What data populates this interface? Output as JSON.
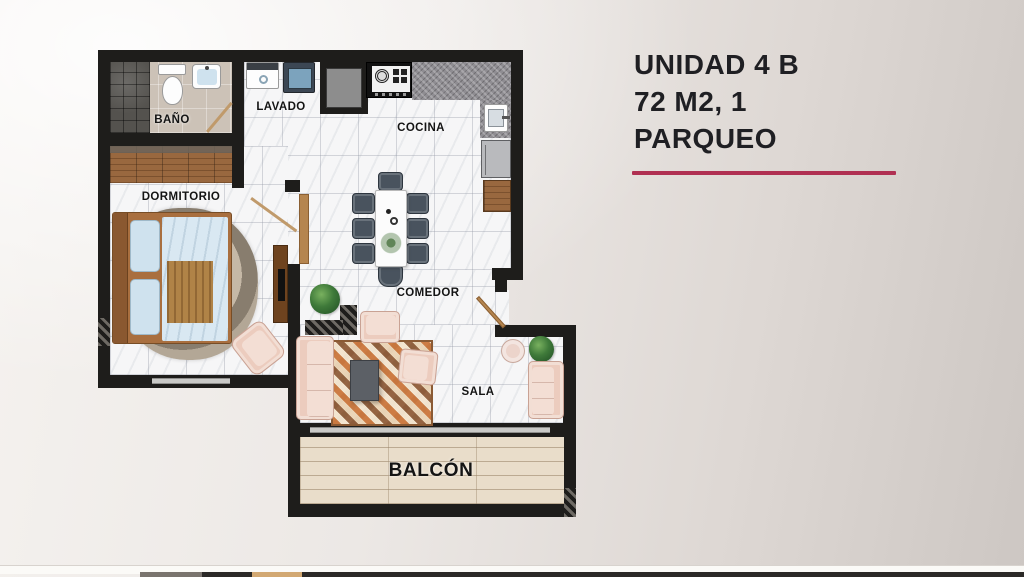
{
  "slide": {
    "title_lines": [
      "UNIDAD 4 B",
      "72 M2, 1",
      "PARQUEO"
    ],
    "accent_color": "#b03052"
  },
  "floorplan": {
    "rooms": {
      "bano": "BAÑO",
      "lavado": "LAVADO",
      "cocina": "COCINA",
      "dormitorio": "DORMITORIO",
      "comedor": "COMEDOR",
      "sala": "SALA",
      "balcon": "BALCÓN"
    }
  }
}
